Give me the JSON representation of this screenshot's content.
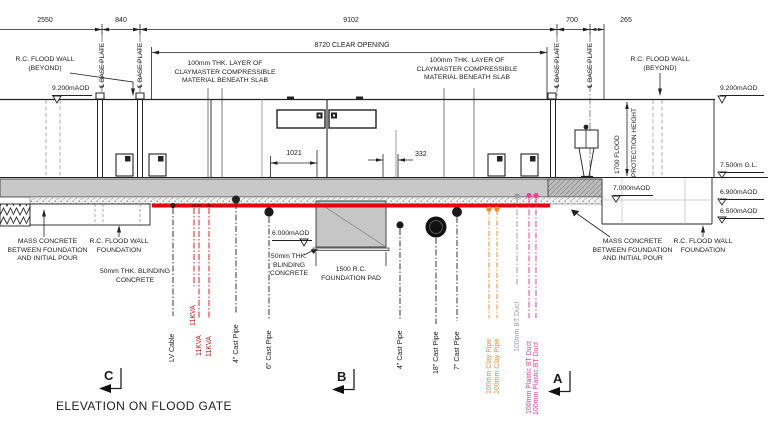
{
  "title": "ELEVATION ON FLOOD GATE",
  "dimensions": {
    "d2550": "2550",
    "d840": "840",
    "d9102": "9102",
    "d700": "700",
    "d265": "265",
    "clear_opening": "8720 CLEAR OPENING",
    "d1021": "1021",
    "d332": "332"
  },
  "flood_height": {
    "l1": "1700 FLOOD",
    "l2": "PROTECTION HEIGHT"
  },
  "levels": {
    "l9200": "9.200mAOD",
    "gl": "7.500m G.L.",
    "l7000": "7.000mAOD",
    "l6900": "6.900mAOD",
    "l6500": "6.500mAOD",
    "l6000": "6.000mAOD"
  },
  "wall_beyond": {
    "l1": "R.C. FLOOD WALL",
    "l2": "(BEYOND)"
  },
  "base_plate": "℄ BASE PLATE",
  "claymaster": {
    "l1": "100mm THK. LAYER OF",
    "l2": "CLAYMASTER COMPRESSIBLE",
    "l3": "MATERIAL BENEATH SLAB"
  },
  "mass_concrete": {
    "l1": "MASS CONCRETE",
    "l2": "BETWEEN FOUNDATION",
    "l3": "AND INITIAL POUR"
  },
  "wall_foundation": {
    "l1": "R.C. FLOOD WALL",
    "l2": "FOUNDATION"
  },
  "blinding_left": {
    "l1": "50mm THK. BLINDING",
    "l2": "CONCRETE"
  },
  "blinding_pad": {
    "l1": "50mm THK.",
    "l2": "BLINDING",
    "l3": "CONCRETE"
  },
  "foundation_pad": {
    "l1": "1500 R.C.",
    "l2": "FOUNDATION PAD"
  },
  "utilities": {
    "lv_cable": "LV Cable",
    "kva": "11KVA",
    "cast_pipe_4": "4\" Cast Pipe",
    "cast_pipe_6": "6\" Cast Pipe",
    "cast_pipe_18": "18\" Cast Pipe",
    "cast_pipe_7": "7\" Cast Pipe",
    "clay_pipe": "100mm Clay Pipe",
    "bt_duct": "100mm BT Duct",
    "plastic_bt_duct": "100mm Plastic BT Duct"
  },
  "section_markers": {
    "c": "C",
    "b": "B",
    "a": "A"
  },
  "colors": {
    "line_red": "#e8000b",
    "utility_orange": "#f08b28",
    "utility_pink": "#ee3f98",
    "utility_gray": "#9a9fa3",
    "slab_gray": "#c8c8c8"
  }
}
